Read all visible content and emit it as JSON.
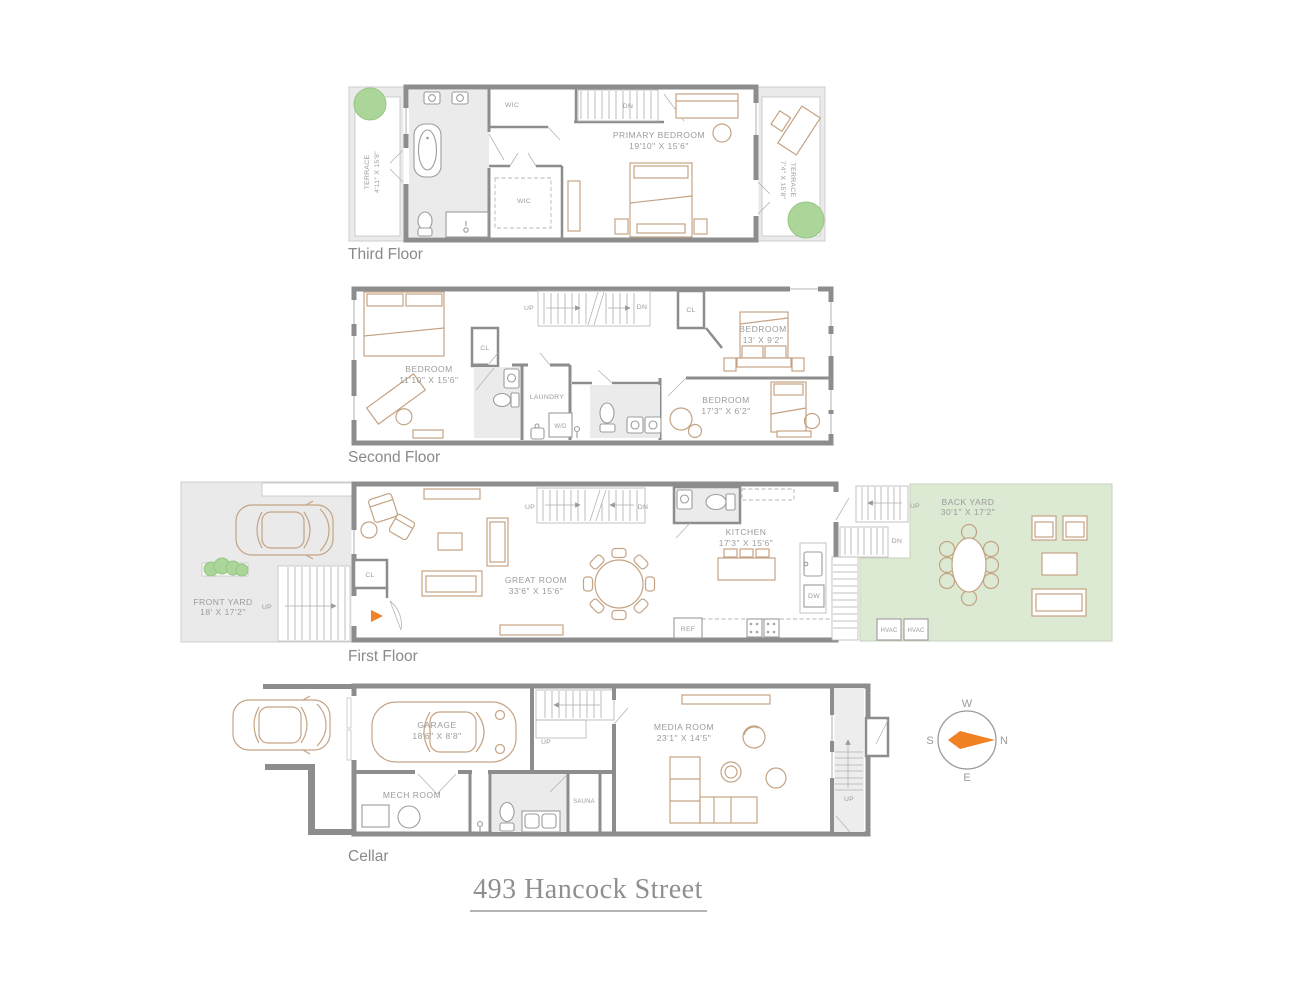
{
  "title": "493 Hancock Street",
  "colors": {
    "wall": "#8d8d8d",
    "furniture_outline": "#c4a384",
    "room_fill": "#ebebeb",
    "terrace_fill": "#eaeaea",
    "yard_green": "#dce9d3",
    "tree_green": "#abd599",
    "label_text": "#9b9b9b",
    "floor_label_text": "#8a8a8a",
    "entry_arrow": "#f08223"
  },
  "floors": {
    "third": {
      "label": "Third Floor",
      "terrace_left_name": "TERRACE",
      "terrace_left_dims": "4'11\" X 15'8\"",
      "terrace_right_name": "TERRACE",
      "terrace_right_dims": "7'4\" X 15'8\"",
      "wic_top": "WIC",
      "wic_center": "WIC",
      "stairs_dn": "DN",
      "primary_bedroom_name": "PRIMARY BEDROOM",
      "primary_bedroom_dims": "19'10\" X 15'6\""
    },
    "second": {
      "label": "Second Floor",
      "bedroom_left_name": "BEDROOM",
      "bedroom_left_dims": "11'10\" X 15'6\"",
      "closet_left": "CL",
      "closet_right": "CL",
      "stairs_up": "UP",
      "stairs_dn": "DN",
      "bedroom_top_right_name": "BEDROOM",
      "bedroom_top_right_dims": "13' X 9'2\"",
      "laundry": "LAUNDRY",
      "washer_dryer": "W/D",
      "bedroom_bottom_right_name": "BEDROOM",
      "bedroom_bottom_right_dims": "17'3\" X 6'2\""
    },
    "first": {
      "label": "First Floor",
      "front_yard_name": "FRONT YARD",
      "front_yard_dims": "18' X 17'2\"",
      "front_steps_up": "UP",
      "closet": "CL",
      "great_room_name": "GREAT ROOM",
      "great_room_dims": "33'6\" X 15'6\"",
      "stairs_up": "UP",
      "stairs_dn": "DN",
      "kitchen_name": "KITCHEN",
      "kitchen_dims": "17'3\" X 15'6\"",
      "dishwasher": "DW",
      "refrigerator": "REF",
      "rear_stairs_up": "UP",
      "rear_stairs_dn": "DN",
      "back_yard_name": "BACK YARD",
      "back_yard_dims": "30'1\" X 17'2\"",
      "hvac_left": "HVAC",
      "hvac_right": "HVAC"
    },
    "cellar": {
      "label": "Cellar",
      "garage_name": "GARAGE",
      "garage_dims": "18'6\" X 8'8\"",
      "stairs_up": "UP",
      "mech_room": "MECH ROOM",
      "sauna": "SAUNA",
      "media_room_name": "MEDIA ROOM",
      "media_room_dims": "23'1\" X 14'5\"",
      "rear_stairs_up": "UP"
    }
  },
  "compass": {
    "north": "N",
    "south": "S",
    "east": "E",
    "west": "W"
  }
}
